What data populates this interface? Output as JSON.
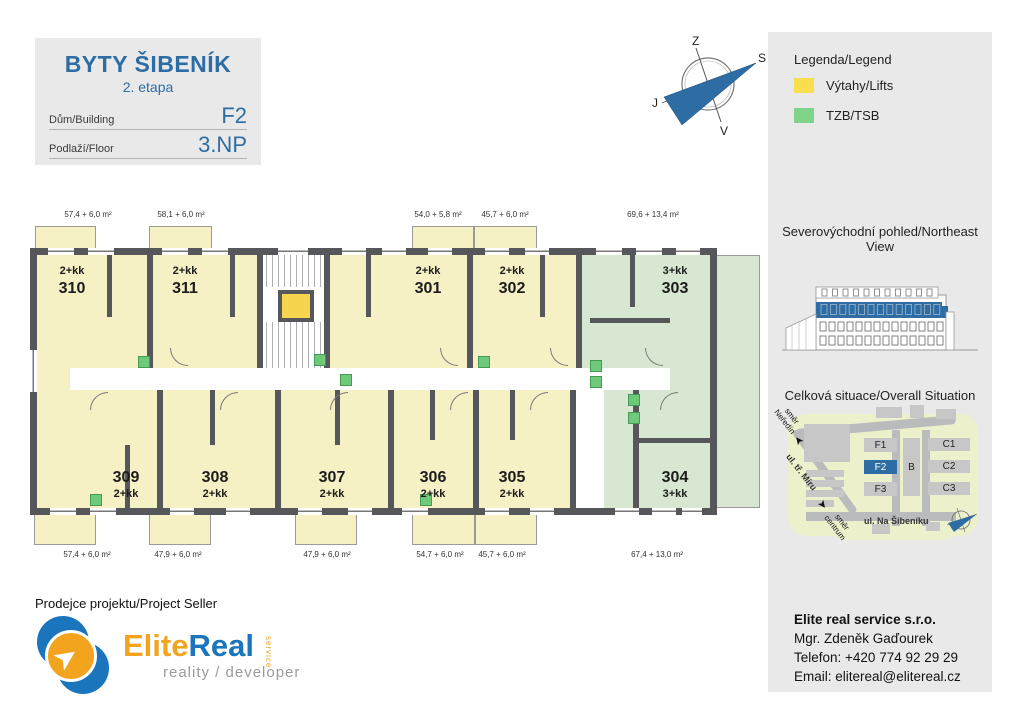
{
  "header": {
    "project": "BYTY ŠIBENÍK",
    "stage": "2. etapa",
    "building_label": "Dům/Building",
    "building_value": "F2",
    "floor_label": "Podlaží/Floor",
    "floor_value": "3.NP"
  },
  "compass": {
    "top": "Z",
    "right": "S",
    "left": "J",
    "bottom": "V"
  },
  "legend": {
    "title": "Legenda/Legend",
    "items": [
      {
        "label": "Výtahy/Lifts",
        "color": "#f9df4e"
      },
      {
        "label": "TZB/TSB",
        "color": "#7fd489"
      }
    ]
  },
  "views": {
    "northeast_title": "Severovýchodní pohled/Northeast View",
    "situation_title": "Celková situace/Overall Situation"
  },
  "situation": {
    "buildings": [
      "F1",
      "F2",
      "F3",
      "B",
      "C1",
      "C2",
      "C3"
    ],
    "highlighted": "F2",
    "street_diagonal": "ul. tř. Míru",
    "street_bottom": "ul. Na Šibeníku",
    "direction_up": {
      "l1": "směr",
      "l2": "Neředín"
    },
    "direction_down": {
      "l1": "směr",
      "l2": "centrum"
    }
  },
  "floorplan": {
    "top_areas": [
      "57,4 + 6,0 m²",
      "58,1 + 6,0 m²",
      "54,0 + 5,8 m²",
      "45,7 + 6,0 m²",
      "69,6 + 13,4 m²"
    ],
    "bottom_areas": [
      "57,4 + 6,0 m²",
      "47,9 + 6,0 m²",
      "47,9 + 6,0 m²",
      "54,7 + 6,0 m²",
      "45,7 + 6,0 m²",
      "67,4 + 13,0 m²"
    ],
    "units_top": [
      {
        "type": "2+kk",
        "number": "310"
      },
      {
        "type": "2+kk",
        "number": "311"
      },
      {
        "type": "2+kk",
        "number": "301"
      },
      {
        "type": "2+kk",
        "number": "302"
      },
      {
        "type": "3+kk",
        "number": "303"
      }
    ],
    "units_bottom": [
      {
        "number": "309",
        "type": "2+kk"
      },
      {
        "number": "308",
        "type": "2+kk"
      },
      {
        "number": "307",
        "type": "2+kk"
      },
      {
        "number": "306",
        "type": "2+kk"
      },
      {
        "number": "305",
        "type": "2+kk"
      },
      {
        "number": "304",
        "type": "3+kk"
      }
    ]
  },
  "seller": {
    "heading": "Prodejce projektu/Project Seller",
    "logo": {
      "part1": "Elite",
      "part2": "Real",
      "service": "service",
      "tagline": "reality / developer"
    }
  },
  "contact": {
    "company": "Elite real service s.r.o.",
    "person": "Mgr. Zdeněk Gaďourek",
    "phone": "Telefon: +420 774 92 29 29",
    "email": "Email: elitereal@elitereal.cz"
  },
  "colors": {
    "accent_blue": "#2e6da4",
    "room_yellow": "#f6f1c4",
    "room_green": "#d8e7d1",
    "lift_yellow": "#f6d44d",
    "tzb_green": "#6fc97a",
    "legend_yellow": "#f9df4e",
    "legend_green": "#7fd489",
    "wall_gray": "#56575a",
    "panel_gray": "#e9e9e9"
  }
}
